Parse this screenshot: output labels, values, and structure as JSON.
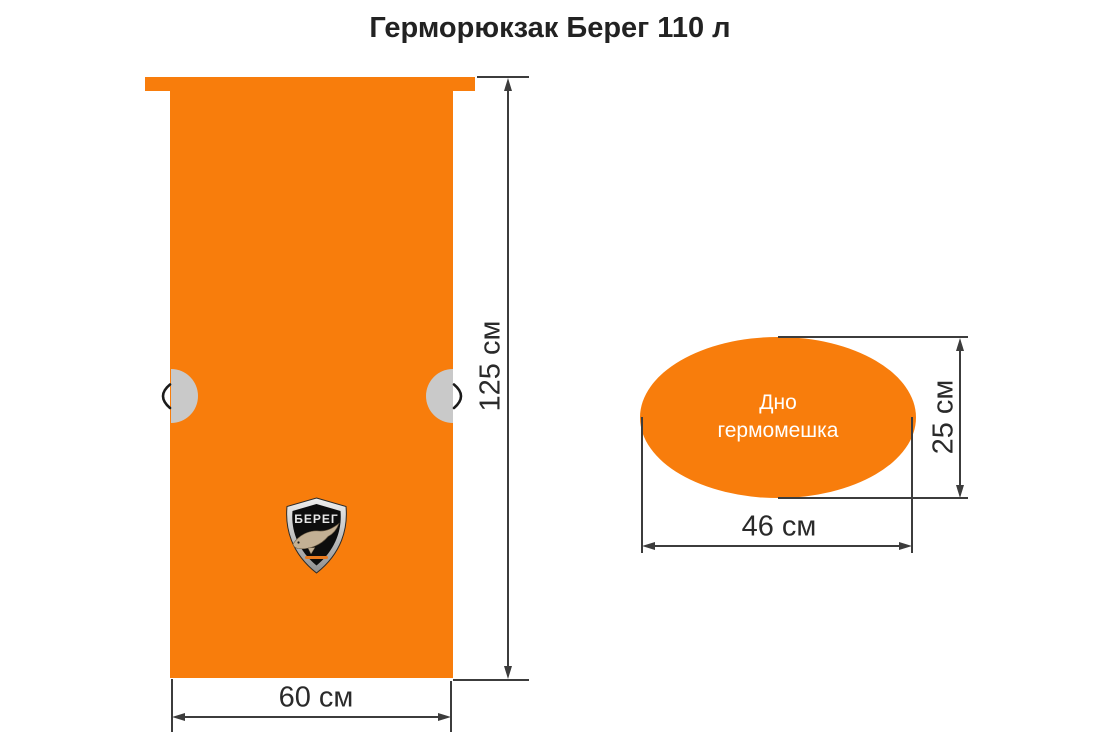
{
  "title": "Герморюкзак Берег 110 л",
  "front_view": {
    "name": "Front view of dry backpack",
    "height_label": "125 см",
    "width_label": "60 см",
    "logo_text": "БЕРЕГ"
  },
  "bottom_view": {
    "name": "Bottom of dry bag",
    "label_line1": "Дно",
    "label_line2": "гермомешка",
    "height_label": "25 см",
    "width_label": "46 см"
  },
  "colors": {
    "bag_orange": "#F87D0C",
    "grommet_grey": "#C9C9C9",
    "dimension_line": "#3C3C3C",
    "text_dark": "#262626",
    "ellipse_text": "#FFFFFF",
    "logo_shield_black": "#0D0D0D",
    "logo_rim_silver": "#D6D6D6",
    "logo_fish_tan": "#C3B094",
    "logo_fineprint_orange": "#E87A1F"
  }
}
